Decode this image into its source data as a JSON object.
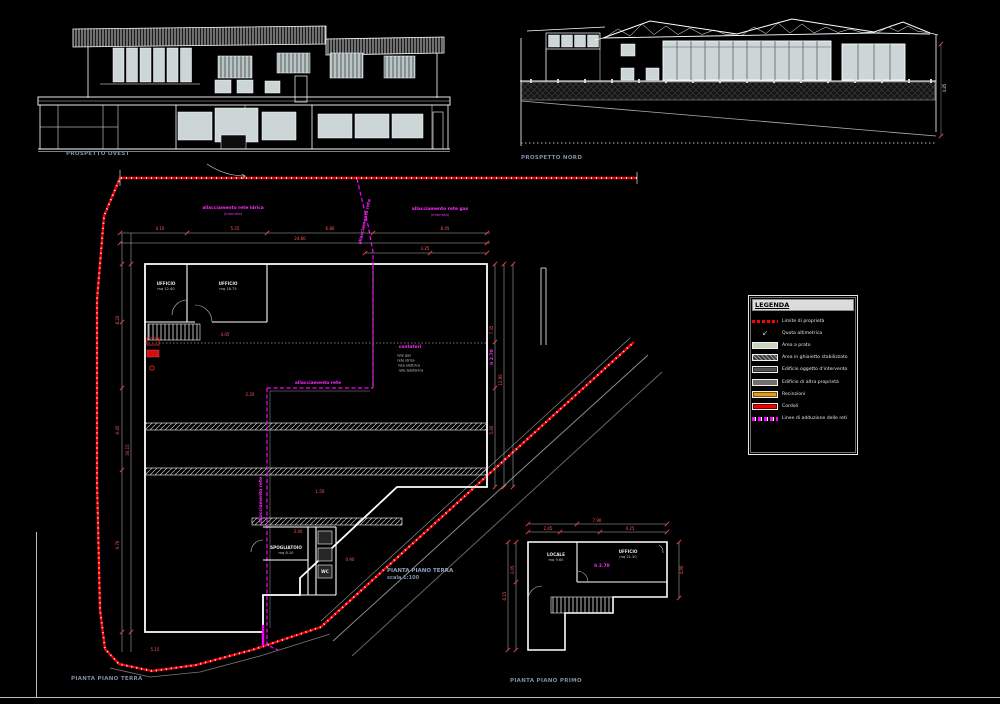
{
  "sheet": {
    "background": "#000000"
  },
  "elevations": {
    "west_label": "PROSPETTO OVEST",
    "north_label": "PROSPETTO NORD"
  },
  "plans": {
    "ground_title": "PIANTA PIANO TERRA",
    "ground_scale": "scala 1:100",
    "ground_corner_label": "PIANTA PIANO TERRA",
    "first_corner_label": "PIANTA PIANO PRIMO"
  },
  "legend": {
    "title": "LEGENDA",
    "compass_n": "N",
    "quota_glyph": "↙",
    "items": [
      {
        "label": "Limite di proprietà",
        "swatch": "red-dash"
      },
      {
        "label": "Quota altimetrica",
        "swatch": "quota-icon"
      },
      {
        "label": "Area a prato",
        "swatch": "green"
      },
      {
        "label": "Area in ghiaietto stabilizzato",
        "swatch": "gray-hatch"
      },
      {
        "label": "Edificio oggetto d'intervento",
        "swatch": "gray-dark"
      },
      {
        "label": "Edificio di altra proprietà",
        "swatch": "gray"
      },
      {
        "label": "Recinzioni",
        "swatch": "orange"
      },
      {
        "label": "Cordoli",
        "swatch": "red"
      },
      {
        "label": "Linee di adduzione delle reti",
        "swatch": "magenta-dash"
      }
    ]
  },
  "colors": {
    "background": "#000000",
    "linework": "#ffffff",
    "glass": "#ccd6d6",
    "boundary_red": "#ff0000",
    "utility_magenta": "#ff00ff",
    "dimension_red": "#ff5a5a",
    "label_blue": "#7d8fa8",
    "legend_green": "#c9d4bd",
    "legend_orange": "#e09a1e"
  },
  "floating_labels": [
    {
      "cls": "dim",
      "t": "4.10",
      "x": 160,
      "y": 229
    },
    {
      "cls": "dim",
      "t": "5.25",
      "x": 235,
      "y": 229
    },
    {
      "cls": "dim",
      "t": "6.80",
      "x": 330,
      "y": 229
    },
    {
      "cls": "dim",
      "t": "8.45",
      "x": 445,
      "y": 229
    },
    {
      "cls": "dim",
      "t": "24.60",
      "x": 300,
      "y": 239
    },
    {
      "cls": "dim",
      "t": "3.25",
      "x": 425,
      "y": 249
    },
    {
      "cls": "dim",
      "t": "8.20",
      "x": 118,
      "y": 320,
      "rot": -90
    },
    {
      "cls": "dim",
      "t": "6.45",
      "x": 118,
      "y": 430,
      "rot": -90
    },
    {
      "cls": "dim",
      "t": "9.70",
      "x": 118,
      "y": 545,
      "rot": -90
    },
    {
      "cls": "dim",
      "t": "30.15",
      "x": 128,
      "y": 450,
      "rot": -90
    },
    {
      "cls": "dim",
      "t": "7.35",
      "x": 492,
      "y": 330,
      "rot": -90
    },
    {
      "cls": "dim",
      "t": "5.60",
      "x": 492,
      "y": 430,
      "rot": -90
    },
    {
      "cls": "dim",
      "t": "12.95",
      "x": 501,
      "y": 380,
      "rot": -90
    },
    {
      "cls": "dim",
      "t": "4.05",
      "x": 225,
      "y": 335
    },
    {
      "cls": "dim",
      "t": "2.20",
      "x": 250,
      "y": 395
    },
    {
      "cls": "dim",
      "t": "1.50",
      "x": 320,
      "y": 492
    },
    {
      "cls": "dim",
      "t": "3.40",
      "x": 298,
      "y": 532
    },
    {
      "cls": "dim",
      "t": "0.90",
      "x": 350,
      "y": 560
    },
    {
      "cls": "dim",
      "t": "5.15",
      "x": 155,
      "y": 650
    },
    {
      "cls": "mag",
      "t": "h 2.70",
      "x": 493,
      "y": 357,
      "rot": -90
    },
    {
      "cls": "dimw",
      "t": "4.85",
      "x": 945,
      "y": 88,
      "rot": -90
    },
    {
      "cls": "room",
      "t": "UFFICIO",
      "x": 166,
      "y": 284
    },
    {
      "cls": "roomsub",
      "t": "mq 12.40",
      "x": 166,
      "y": 290
    },
    {
      "cls": "room",
      "t": "UFFICIO",
      "x": 228,
      "y": 284
    },
    {
      "cls": "roomsub",
      "t": "mq 18.75",
      "x": 228,
      "y": 290
    },
    {
      "cls": "room",
      "t": "SPOGLIATOIO",
      "x": 286,
      "y": 548
    },
    {
      "cls": "roomsub",
      "t": "mq 8.10",
      "x": 286,
      "y": 554
    },
    {
      "cls": "room",
      "t": "WC",
      "x": 325,
      "y": 572
    },
    {
      "cls": "mag",
      "t": "contatori",
      "x": 410,
      "y": 348
    },
    {
      "cls": "note",
      "t": "rete gas",
      "x": 404,
      "y": 356
    },
    {
      "cls": "note",
      "t": "rete idrica",
      "x": 406,
      "y": 361
    },
    {
      "cls": "note",
      "t": "rete elettrica",
      "x": 409,
      "y": 366
    },
    {
      "cls": "note",
      "t": "rete telefonica",
      "x": 411,
      "y": 371
    },
    {
      "cls": "mag",
      "t": "allacciamento rete idrica",
      "x": 233,
      "y": 209
    },
    {
      "cls": "magsub",
      "t": "(interrata)",
      "x": 233,
      "y": 215
    },
    {
      "cls": "mag",
      "t": "allacciamento rete gas",
      "x": 440,
      "y": 210
    },
    {
      "cls": "magsub",
      "t": "(interrata)",
      "x": 440,
      "y": 216
    },
    {
      "cls": "mag",
      "t": "allacciamento rete",
      "x": 318,
      "y": 384
    },
    {
      "cls": "magv",
      "t": "allacciamento rete",
      "x": 262,
      "y": 500,
      "rot": -90
    },
    {
      "cls": "magv",
      "t": "allacciamento rete",
      "x": 366,
      "y": 222,
      "rot": -78
    },
    {
      "cls": "room",
      "t": "LOCALE",
      "x": 556,
      "y": 555
    },
    {
      "cls": "roomsub",
      "t": "mq 9.60",
      "x": 556,
      "y": 561
    },
    {
      "cls": "room",
      "t": "UFFICIO",
      "x": 628,
      "y": 552
    },
    {
      "cls": "roomsub",
      "t": "mq 21.30",
      "x": 628,
      "y": 558
    },
    {
      "cls": "mag",
      "t": "h 2.70",
      "x": 602,
      "y": 567
    },
    {
      "cls": "dim",
      "t": "7.90",
      "x": 597,
      "y": 521
    },
    {
      "cls": "dim",
      "t": "2.45",
      "x": 548,
      "y": 529
    },
    {
      "cls": "dim",
      "t": "4.25",
      "x": 630,
      "y": 529
    },
    {
      "cls": "dim",
      "t": "6.15",
      "x": 505,
      "y": 596,
      "rot": -90
    },
    {
      "cls": "dim",
      "t": "3.05",
      "x": 513,
      "y": 570,
      "rot": -90
    },
    {
      "cls": "dim",
      "t": "4.90",
      "x": 682,
      "y": 570,
      "rot": -90
    }
  ]
}
